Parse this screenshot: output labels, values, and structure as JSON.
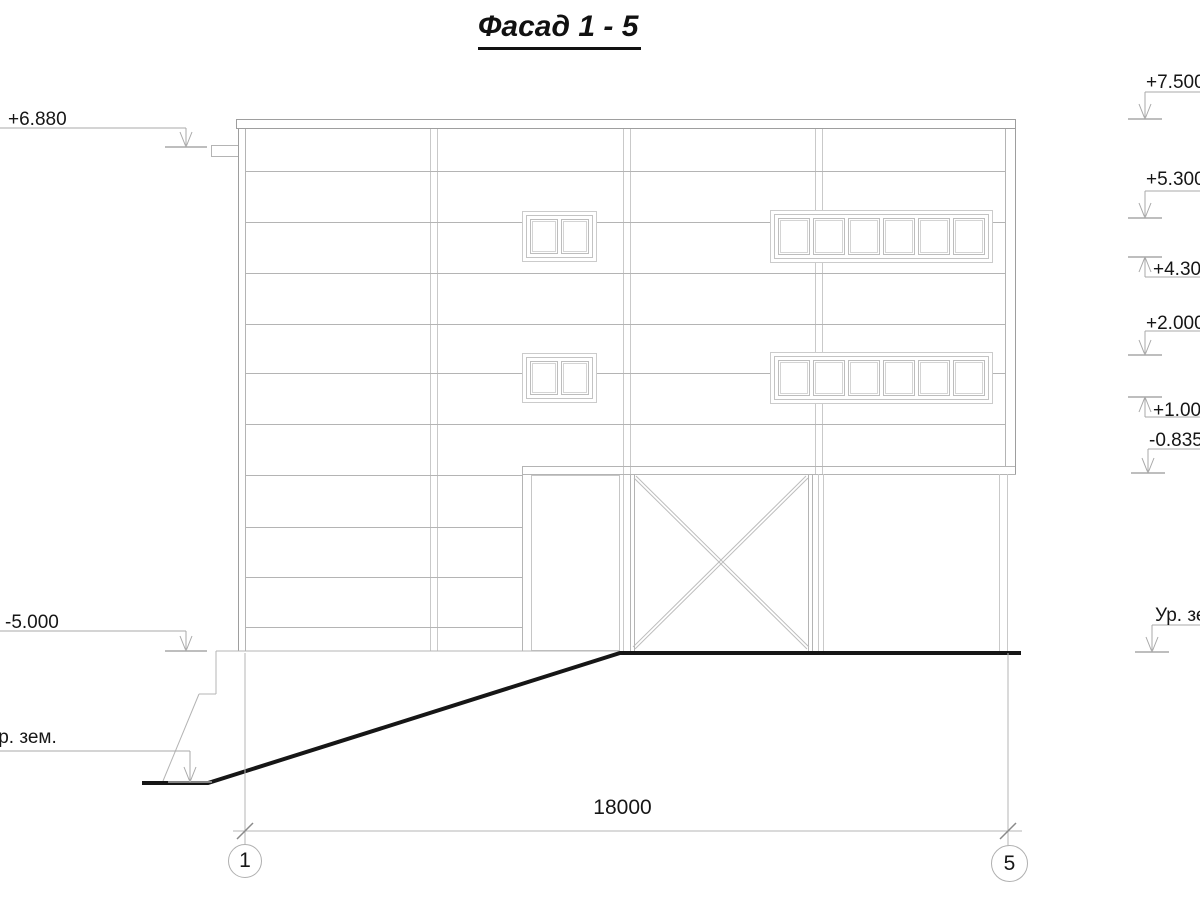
{
  "title": "Фасад 1 - 5",
  "elevations": {
    "left": [
      {
        "label": "+6.880"
      },
      {
        "label": "-5.000"
      },
      {
        "label": "Ур. зем."
      }
    ],
    "right": [
      {
        "label": "+7.500"
      },
      {
        "label": "+5.300"
      },
      {
        "label": "+4.300"
      },
      {
        "label": "+2.000"
      },
      {
        "label": "+1.000"
      },
      {
        "label": "-0.835"
      },
      {
        "label": "Ур. зем."
      }
    ]
  },
  "dimension": {
    "value": "18000"
  },
  "axes": [
    {
      "label": "1"
    },
    {
      "label": "5"
    }
  ]
}
